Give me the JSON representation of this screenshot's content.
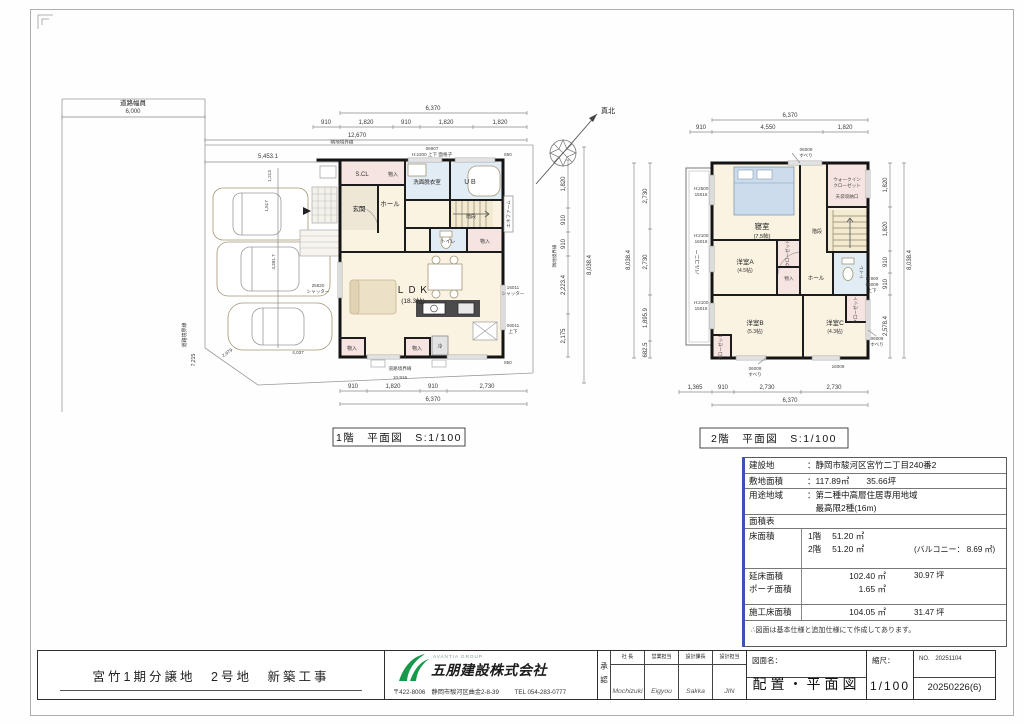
{
  "compass": {
    "north": "真北"
  },
  "site": {
    "road_width_label": "道路幅員",
    "road_width_value": "6,000",
    "road_boundary_left": "道路境界線",
    "road_boundary_left_dim": "7,215",
    "adj_boundary_top": "隣地境界線",
    "adj_boundary_right": "隣地境界線",
    "road_boundary_bottom": "道路境界線",
    "road_boundary_bottom_dim": "10,916",
    "car_len": "5,453.1",
    "car_w1": "1,213",
    "car_w2": "1,517",
    "park_depth": "4,391.7",
    "park_bottom": "4,037",
    "diag_dim": "2,979",
    "shutter_code": "25620",
    "shutter_label": "シャッター"
  },
  "floor1": {
    "caption": "1階　平面図　S:1/100",
    "rooms": {
      "scl": "S.CL",
      "mono1": "物入",
      "senmen": "洗面脱衣室",
      "ub": "ＵＢ",
      "genkan": "玄関",
      "hall": "ホール",
      "stairs": "階段",
      "toilet": "トイレ",
      "mono2": "物入",
      "ldk": "ＬＤＫ",
      "ldk_size": "(18.3帖)",
      "mono3": "物入",
      "mono4": "物入",
      "fridge": "冷"
    },
    "notes": {
      "win_top_code": "06907",
      "win_top_spec": "H:2200 上下  面格子",
      "enefarm": "エネファーム",
      "win_right1": "16011",
      "win_right1b": "シャッター",
      "win_right2": "06011",
      "win_right2b": "上下",
      "off_top": "850",
      "off_bottom": "850"
    },
    "dims": {
      "top_total": "6,370",
      "top_overall": "12,670",
      "top_s1": "910",
      "top_s2": "1,820",
      "top_s3": "910",
      "top_s4": "1,820",
      "top_s5": "1,820",
      "bot_s1": "910",
      "bot_s2": "1,820",
      "bot_s3": "910",
      "bot_s4": "2,730",
      "bot_total": "6,370",
      "r_s1": "1,820",
      "r_s2": "910",
      "r_s3": "910",
      "r_s4": "2,223.4",
      "r_s5": "2,175",
      "right_total": "8,038.4"
    }
  },
  "floor2": {
    "caption": "2階　平面図　S:1/100",
    "rooms": {
      "bedroom": "寝室",
      "bedroom_size": "(7.5帖)",
      "wic1": "ウォークイン",
      "wic2": "クローゼット",
      "tenbukuro": "天袋収納口",
      "stairs": "階段",
      "roomA": "洋室A",
      "roomA_size": "(4.5帖)",
      "closetA": "クローゼット",
      "mono": "物入",
      "hall": "ホール",
      "toilet": "トイレ",
      "roomB": "洋室B",
      "roomB_size": "(5.3帖)",
      "roomC": "洋室C",
      "roomC_size": "(4.3帖)",
      "closetB": "クローゼット",
      "closetC": "クローゼット",
      "balcony": "バルコニー"
    },
    "notes": {
      "win_top": "06009",
      "win_top2": "すべり",
      "win_left1": "H:2500",
      "win_left1b": "15018",
      "win_left2": "H:2100",
      "win_left2b": "16018",
      "win_left3": "H:2100",
      "win_left3b": "15018",
      "win_right1": "H:900",
      "win_right1b": "06009",
      "win_right1c": "上下",
      "win_right2": "06009",
      "win_right2b": "すべり",
      "win_bot1": "06009",
      "win_bot1b": "すべり",
      "win_bot2": "16009"
    },
    "dims": {
      "top_total": "6,370",
      "top_s1": "910",
      "top_s2": "4,550",
      "top_s3": "1,820",
      "bot_s1": "1,365",
      "bot_s2": "910",
      "bot_s3": "2,730",
      "bot_s4": "2,730",
      "bot_total": "6,370",
      "l_s1": "2,730",
      "l_s2": "2,730",
      "l_s3": "1,895.9",
      "l_s4": "682.5",
      "left_total": "8,038.4",
      "r_s1": "1,820",
      "r_s2": "1,820",
      "r_s3": "910",
      "r_s4": "910",
      "r_s5": "2,578.4",
      "right_total": "8,038.4"
    }
  },
  "info_table": {
    "rows": [
      {
        "label": "建設地",
        "value": "：静岡市駿河区宮竹二丁目240番2",
        "extra": ""
      },
      {
        "label": "敷地面積",
        "value": "：117.89㎡　　35.66坪",
        "extra": ""
      },
      {
        "label": "用途地域",
        "value": "：第二種中高層住居専用地域",
        "extra": ""
      },
      {
        "label": "",
        "value": "　最高限2種(16m)",
        "extra": ""
      },
      {
        "label": "面積表",
        "value": "",
        "extra": ""
      },
      {
        "label": "床面積",
        "value": "1階　 51.20 ㎡",
        "extra": ""
      },
      {
        "label": "",
        "value": "2階　 51.20 ㎡",
        "extra": "(バルコニー： 8.69 ㎡)"
      },
      {
        "label": "延床面積",
        "value": "102.40 ㎡",
        "extra": "30.97 坪"
      },
      {
        "label": "ポーチ面積",
        "value": "1.65 ㎡",
        "extra": ""
      },
      {
        "label": "施工床面積",
        "value": "104.05 ㎡",
        "extra": "31.47 坪"
      }
    ],
    "note": "∴図面は基本仕様と追加仕様にて作成してあります。"
  },
  "title_block": {
    "project": "宮竹1期分譲地　2号地　新築工事",
    "group": "AVANTIA GROUP",
    "company": "五朋建設株式会社",
    "address": "〒422-8006　静岡市駿河区曲金2-8-39",
    "tel": "TEL 054-283-0777",
    "approval": "承認",
    "roles": [
      {
        "role": "社 長",
        "name": "Mochizuki"
      },
      {
        "role": "営業担当",
        "name": "Eigyou"
      },
      {
        "role": "設計課長",
        "name": "Sakka"
      },
      {
        "role": "設計担当",
        "name": "JIN"
      }
    ],
    "drawing_label": "図面名：",
    "drawing_name": "配置・平面図",
    "scale_label": "縮尺：",
    "scale_value": "1/100",
    "no_label": "NO.",
    "no_value": "20251104",
    "rev": "20250226(6)"
  }
}
